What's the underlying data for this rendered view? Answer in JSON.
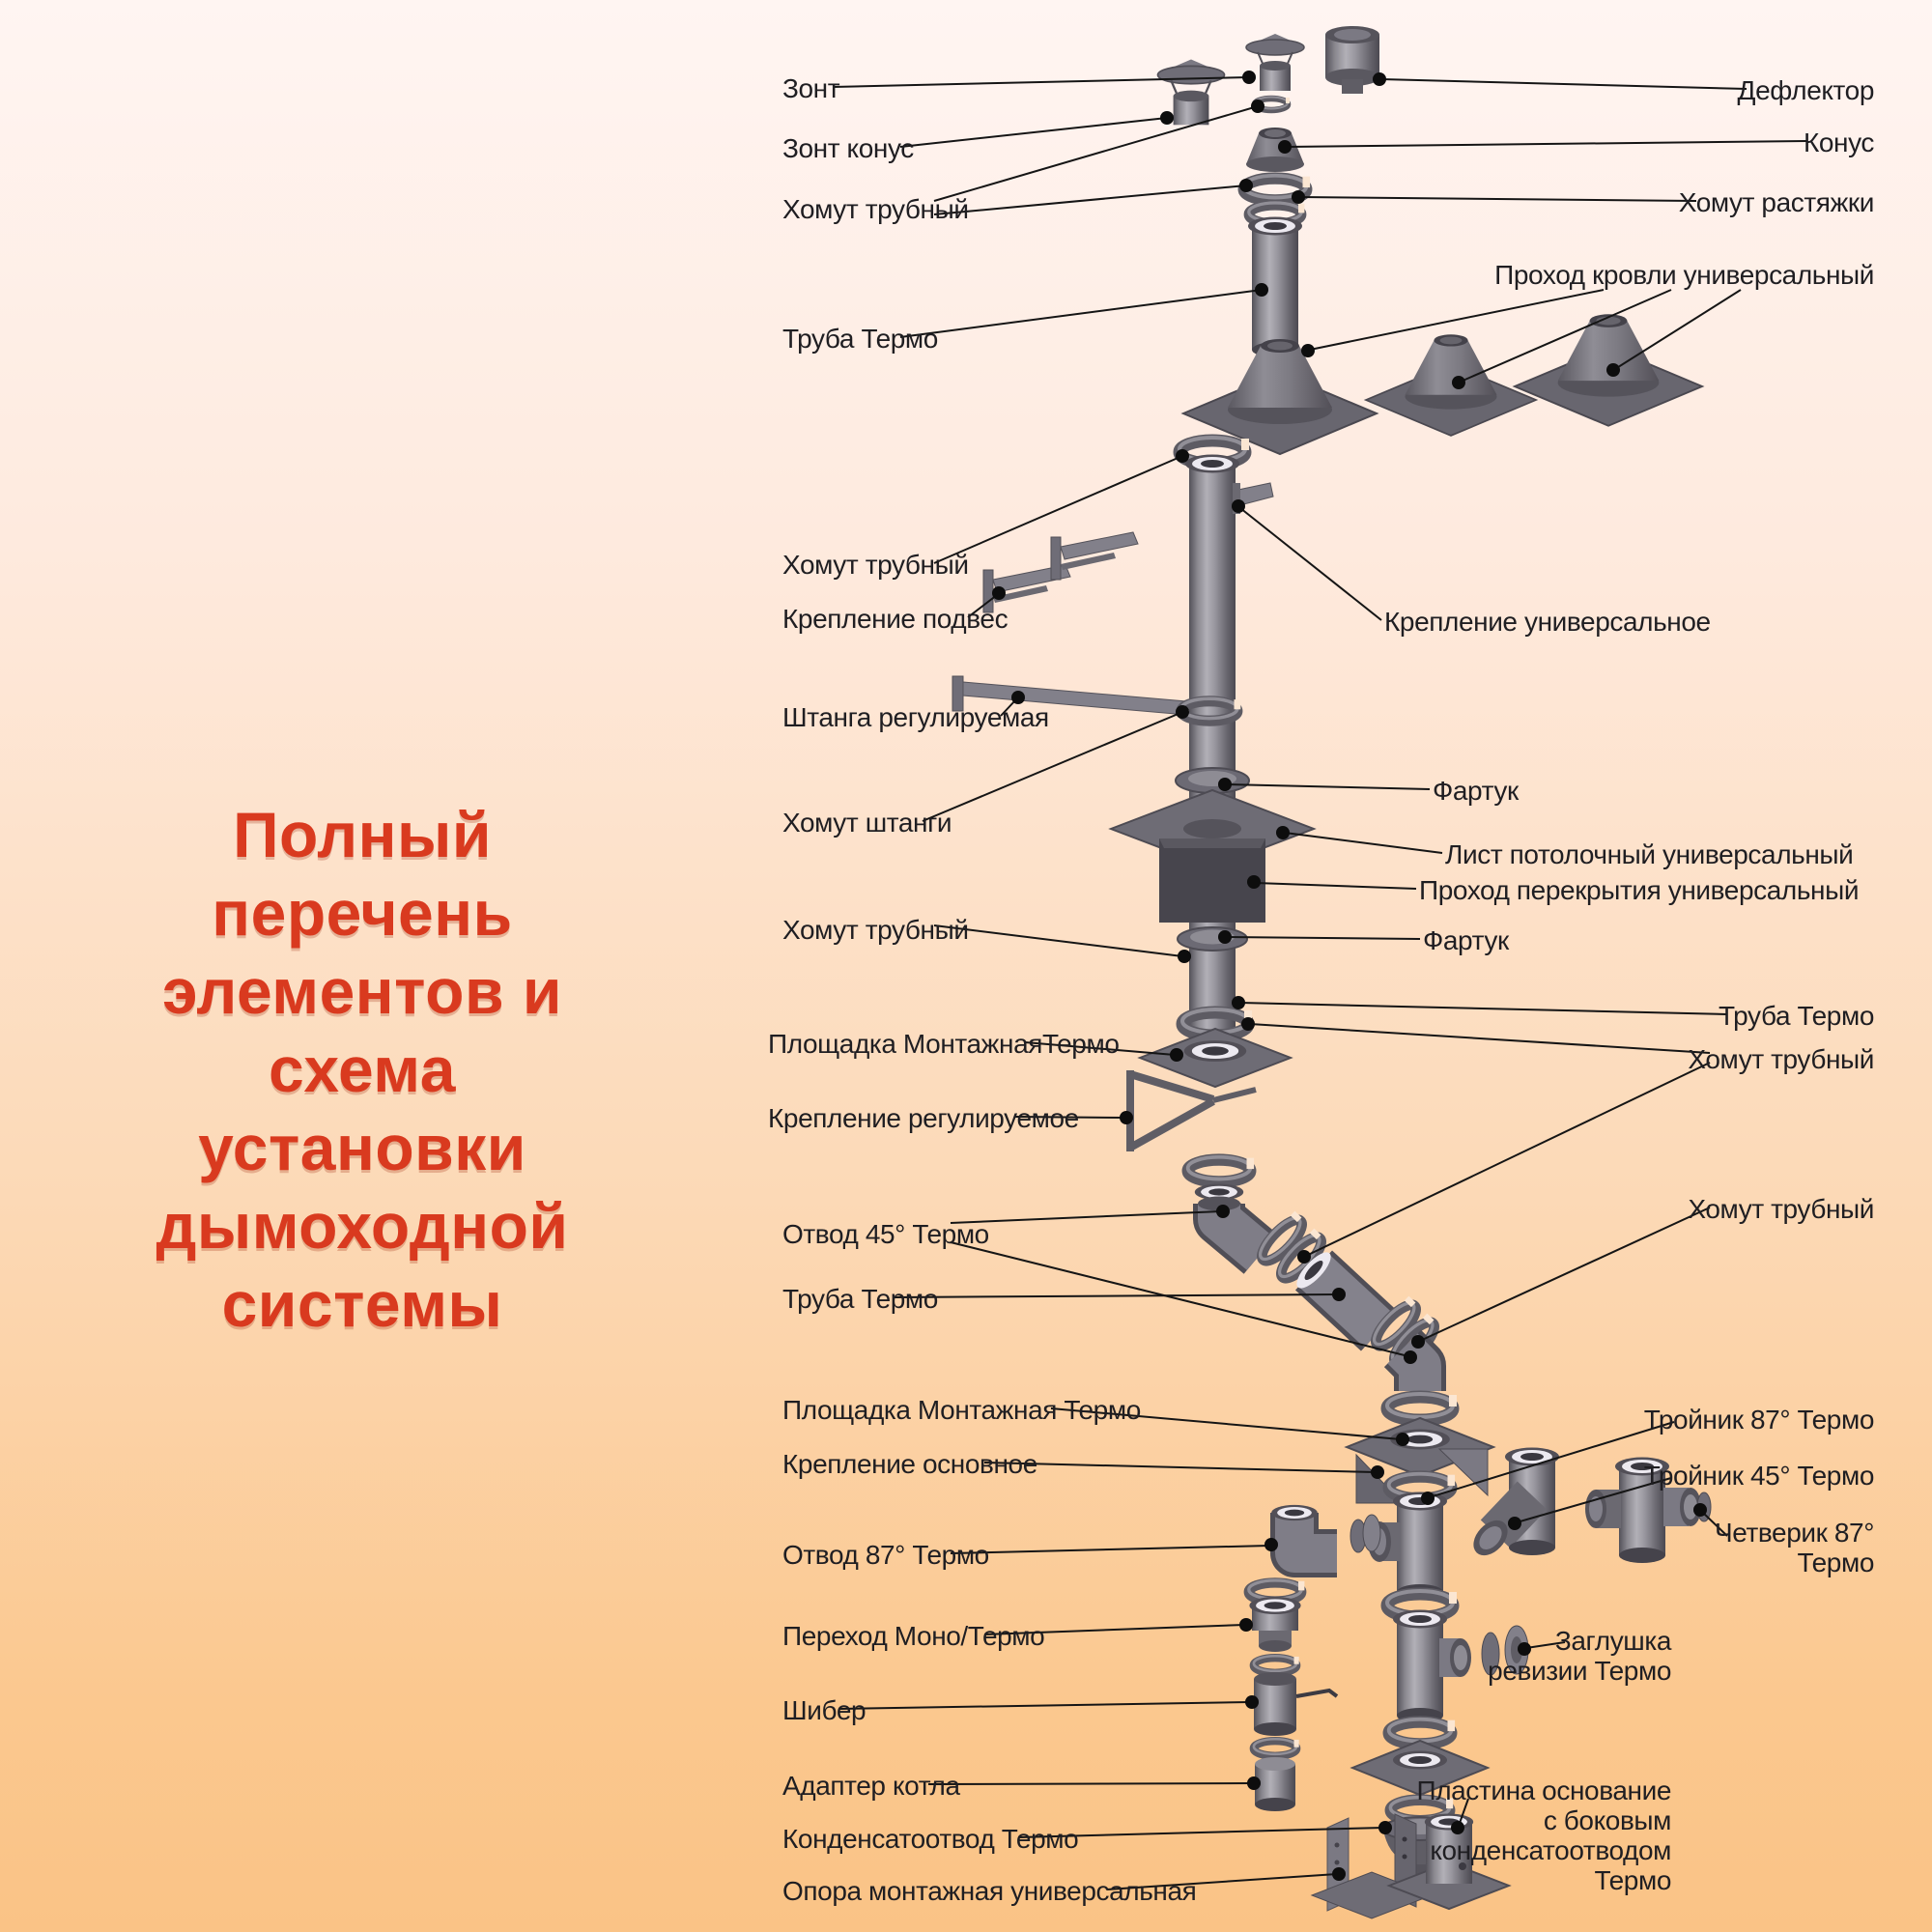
{
  "title": {
    "lines": "Полный перечень\nэлементов и схема\nустановки\nдымоходной\nсистемы",
    "color": "#d93a1f"
  },
  "labels": {
    "left": [
      {
        "id": "zont",
        "text": "Зонт"
      },
      {
        "id": "zont-konus",
        "text": "Зонт конус"
      },
      {
        "id": "homut-trubny-1",
        "text": "Хомут трубный"
      },
      {
        "id": "truba-termo-1",
        "text": "Труба Термо"
      },
      {
        "id": "homut-trubny-2",
        "text": "Хомут трубный"
      },
      {
        "id": "kreplenie-podves",
        "text": "Крепление подвес"
      },
      {
        "id": "shtanga-reguliruemaya",
        "text": "Штанга регулируемая"
      },
      {
        "id": "homut-shtangi",
        "text": "Хомут штанги"
      },
      {
        "id": "homut-trubny-3",
        "text": "Хомут трубный"
      },
      {
        "id": "ploshchadka-montazhnaya-termo-1",
        "text": "Площадка МонтажнаяТермо"
      },
      {
        "id": "kreplenie-reguliruemoe",
        "text": "Крепление регулируемое"
      },
      {
        "id": "otvod-45-termo",
        "text": "Отвод 45° Термо"
      },
      {
        "id": "truba-termo-2",
        "text": "Труба Термо"
      },
      {
        "id": "ploshchadka-montazhnaya-termo-2",
        "text": "Площадка Монтажная Термо"
      },
      {
        "id": "kreplenie-osnovnoe",
        "text": "Крепление основное"
      },
      {
        "id": "otvod-87-termo",
        "text": "Отвод 87° Термо"
      },
      {
        "id": "perekhod-mono-termo",
        "text": "Переход Моно/Термо"
      },
      {
        "id": "shiber",
        "text": "Шибер"
      },
      {
        "id": "adapter-kotla",
        "text": "Адаптер котла"
      },
      {
        "id": "kondensatootvod-termo",
        "text": "Конденсатоотвод Термо"
      },
      {
        "id": "opora-montazhnaya-universalnaya",
        "text": "Опора монтажная универсальная"
      }
    ],
    "right": [
      {
        "id": "deflektor",
        "text": "Дефлектор"
      },
      {
        "id": "konus",
        "text": "Конус"
      },
      {
        "id": "homut-rastyazhki",
        "text": "Хомут растяжки"
      },
      {
        "id": "prokhod-krovli-universalny",
        "text": "Проход кровли универсальный"
      },
      {
        "id": "kreplenie-universalnoe",
        "text": "Крепление универсальное"
      },
      {
        "id": "fartuk-1",
        "text": "Фартук"
      },
      {
        "id": "list-potolochny-universalny",
        "text": "Лист потолочный универсальный"
      },
      {
        "id": "prokhod-perekrytiya-universalny",
        "text": "Проход перекрытия универсальный"
      },
      {
        "id": "fartuk-2",
        "text": "Фартук"
      },
      {
        "id": "truba-termo-r",
        "text": "Труба Термо"
      },
      {
        "id": "homut-trubny-r1",
        "text": "Хомут трубный"
      },
      {
        "id": "homut-trubny-r2",
        "text": "Хомут трубный"
      },
      {
        "id": "troynik-87-termo",
        "text": "Тройник 87° Термо"
      },
      {
        "id": "troynik-45-termo",
        "text": "Тройник 45° Термо"
      },
      {
        "id": "chetverik-87-termo",
        "text": "Четверик 87°\nТермо"
      },
      {
        "id": "zaglushka-revizii-termo",
        "text": "Заглушка\nревизии Термо"
      },
      {
        "id": "plastina-osnovanie",
        "text": "Пластина основание\nс боковым\nконденсатоотводом\nТермо"
      }
    ]
  }
}
